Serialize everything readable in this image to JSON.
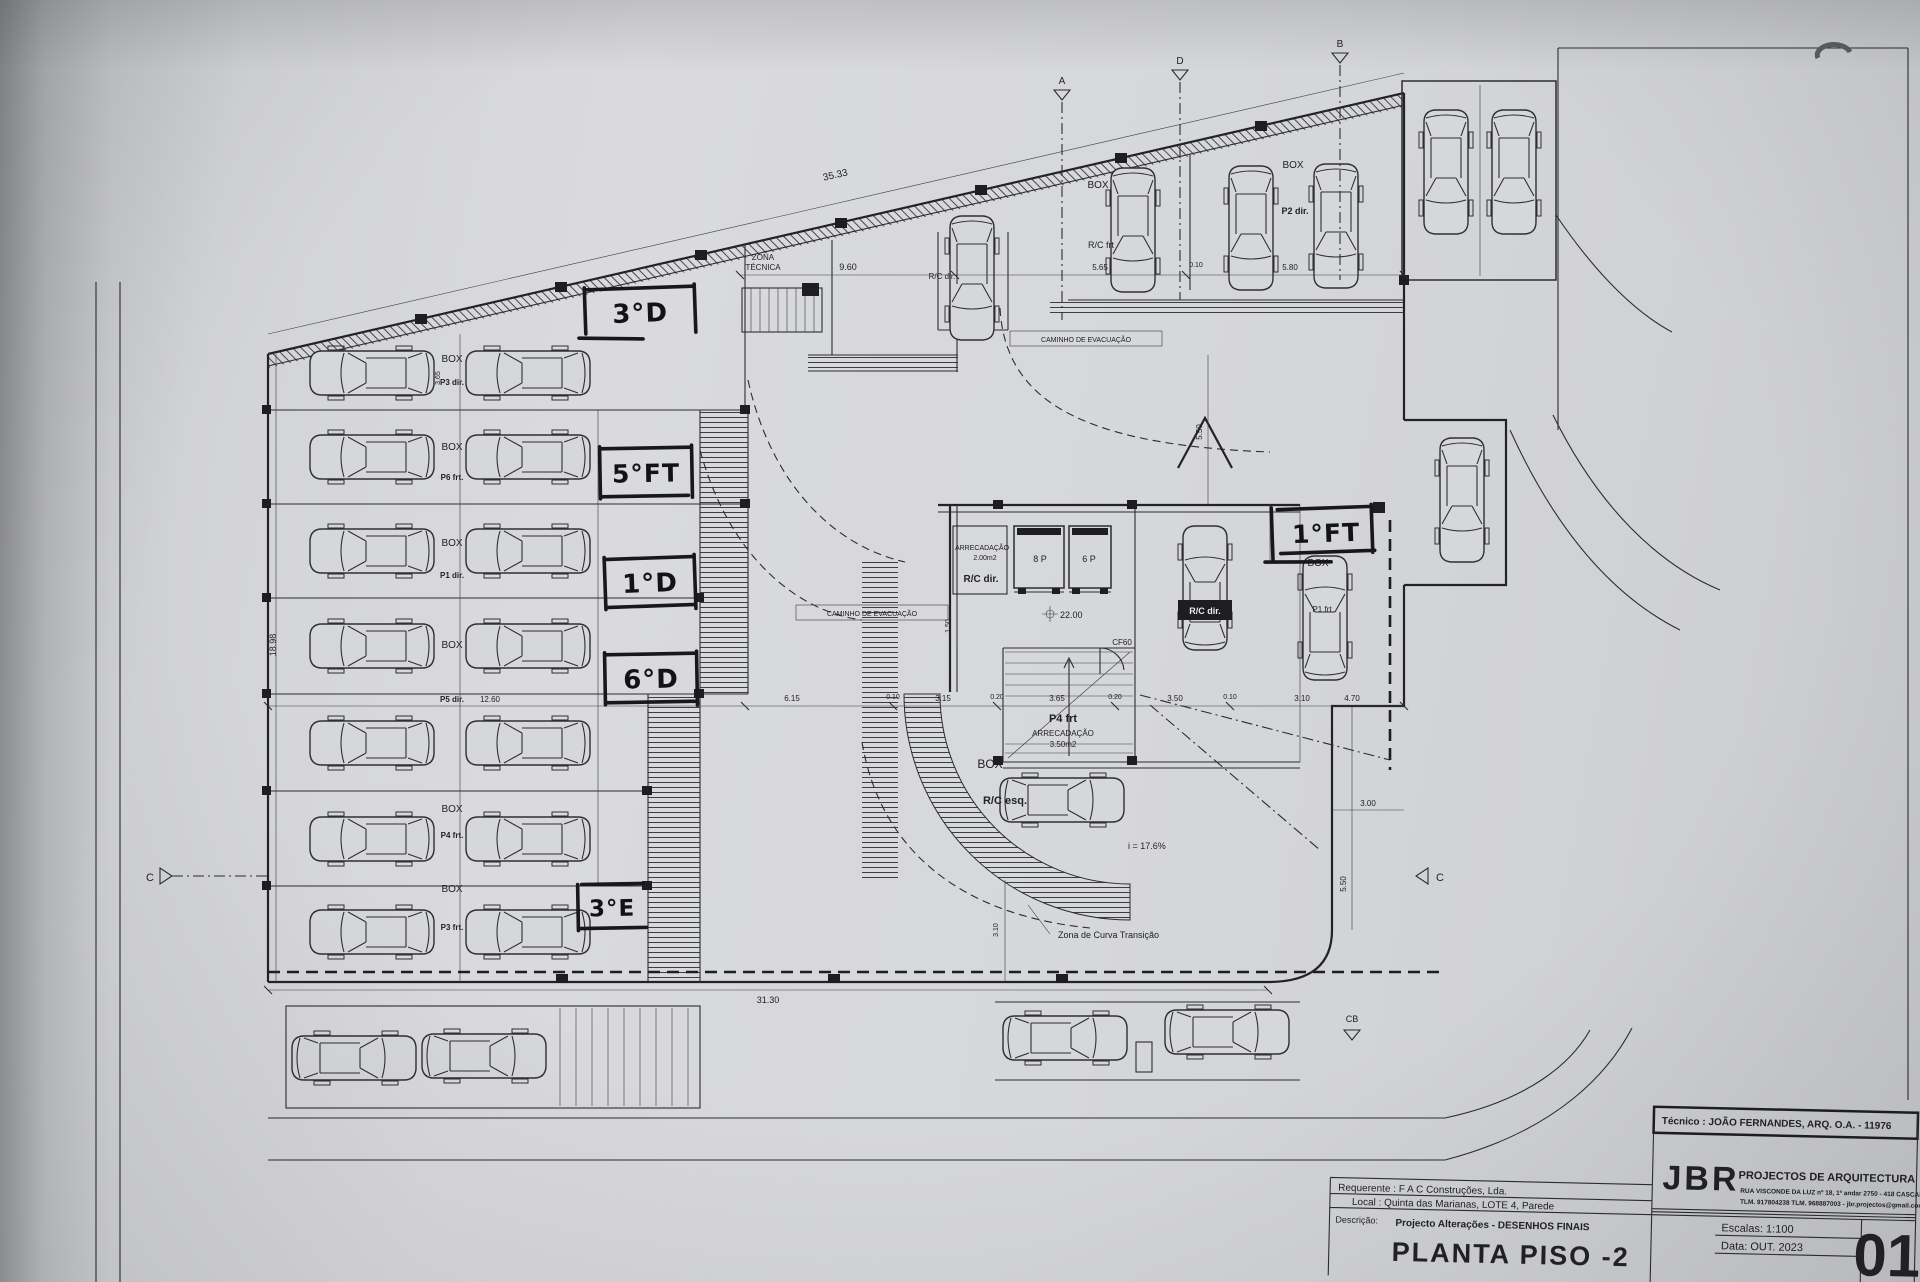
{
  "plan": {
    "box": "BOX",
    "zona1": "ZONA",
    "zona2": "TÉCNICA",
    "caminho": "CAMINHO DE EVACUAÇÃO",
    "zona_curva": "Zona de Curva Transição",
    "slope": "i = 17.6%",
    "level": "22.00",
    "cf60": "CF60",
    "e8p": "8 P",
    "e6p": "6 P",
    "arrec": "ARRECADAÇÃO",
    "a200": "2.00m2",
    "a350": "3.50m2",
    "p4frt": "P4 frt",
    "rcdir": "R/C dir.",
    "rcesq": "R/C esq.",
    "rcfrt": "R/C frt",
    "p2dir": "P2 dir.",
    "p1frt": "P1 frt",
    "rows": [
      {
        "l": "P3 dir."
      },
      {
        "l": "P6 frt."
      },
      {
        "l": "P1 dir."
      },
      {
        "l": "P5 dir."
      },
      {
        "l": "P4 frt."
      },
      {
        "l": "P3 frt."
      }
    ],
    "mk": {
      "a": "A",
      "b": "B",
      "c": "C",
      "d": "D",
      "cb": "CB"
    }
  },
  "dims": {
    "slant": "35.33",
    "d960": "9.60",
    "d565": "5.65",
    "d010": "0.10",
    "d580": "5.80",
    "leftv": "18.98",
    "bottom": "31.30",
    "d1260": "12.60",
    "mid": [
      "6.15",
      "0.10",
      "3.15",
      "0.20",
      "3.65",
      "0.20",
      "3.50",
      "0.10",
      "3.10",
      "4.70"
    ],
    "d300": "3.00",
    "d550": "5.50",
    "d150": "1.50",
    "d310": "3.10",
    "d365": "3.65"
  },
  "hand": {
    "a3d": "3°D",
    "a5ft": "5°FT",
    "a1d": "1°D",
    "a6d": "6°D",
    "a3e": "3°E",
    "a1ft": "1°FT"
  },
  "tb": {
    "tecnico": "Técnico : JOÃO FERNANDES, ARQ.   O.A. - 11976",
    "requerente": "Requerente : F A C Construções, Lda.",
    "local": "Local : Quinta das Marianas, LOTE 4, Parede",
    "descricao_label": "Descrição:",
    "descricao": "Projecto Alterações - DESENHOS FINAIS",
    "drawing_title": "PLANTA PISO -2",
    "firm": "JBR",
    "firm_sub": "PROJECTOS DE ARQUITECTURA",
    "firm_addr": "RUA VISCONDE DA LUZ nº 18, 1º andar   2750 - 418   CASCAIS",
    "firm_tel": "TLM. 917804238 TLM. 968887003 - jbr.projectos@gmail.com",
    "escala": "Escalas: 1:100",
    "data": "Data: OUT. 2023",
    "sheet": "01"
  }
}
